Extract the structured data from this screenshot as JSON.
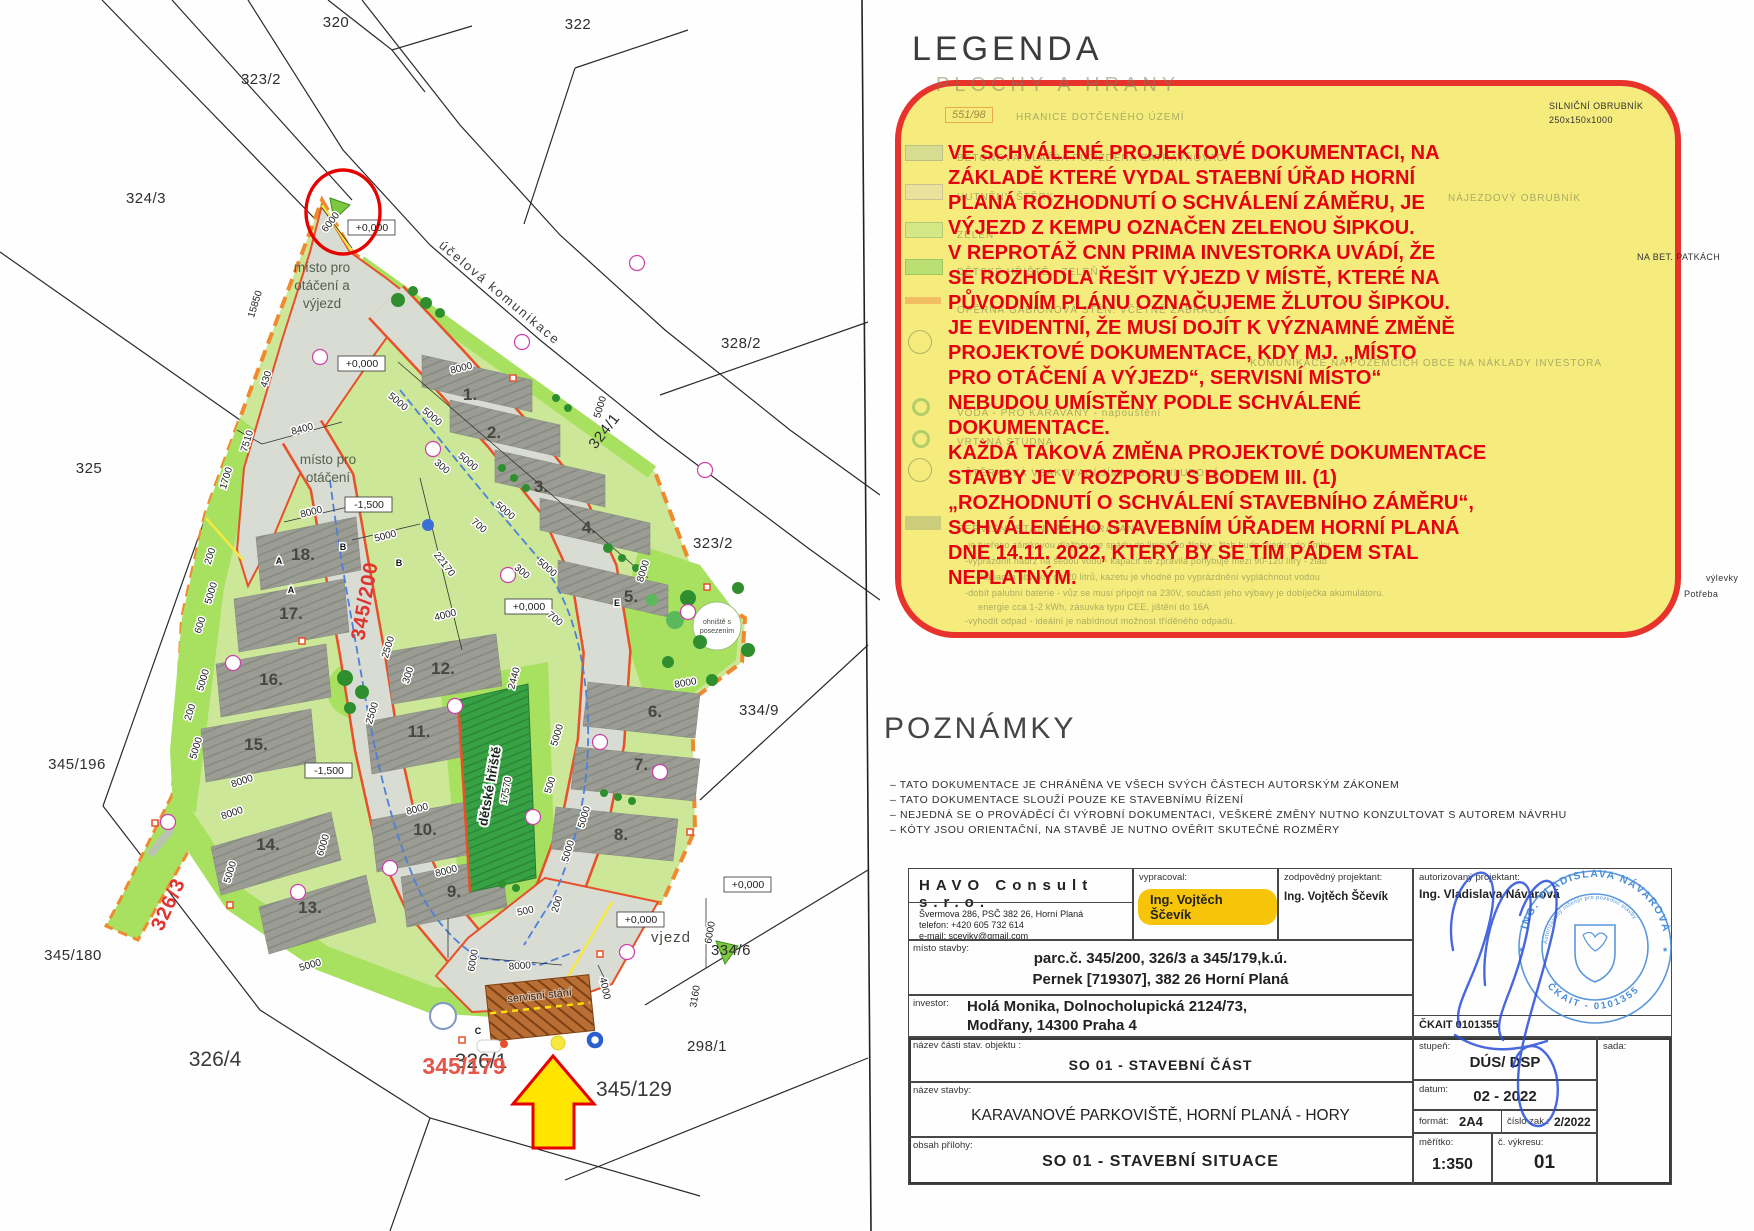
{
  "legend": {
    "title": "LEGENDA",
    "fragments": [
      {
        "t": "PLOCHY A HRANY",
        "x": 936,
        "y": 74,
        "c": "faint-big"
      },
      {
        "t": "551/98",
        "x": 945,
        "y": 107,
        "c": "faint-box"
      },
      {
        "t": "HRANICE DOTČENÉHO ÚZEMÍ",
        "x": 1016,
        "y": 112,
        "c": "faint"
      },
      {
        "t": "BETONOVÁ DLAŽBA POJÍŽDĚNÁ ZATRAVŇOVACÍ",
        "x": 957,
        "y": 153,
        "c": "faint"
      },
      {
        "t": "HUTNĚNÝ ŠTĚRK",
        "x": 957,
        "y": 192,
        "c": "faint"
      },
      {
        "t": "ZELEŇ",
        "x": 957,
        "y": 230,
        "c": "faint"
      },
      {
        "t": "DĚTSKÉ HŘIŠTĚ - ZELEŇ",
        "x": 957,
        "y": 267,
        "c": "faint"
      },
      {
        "t": "OPĚRNÁ GABIONOVÁ STĚN. VČETNĚ ZÁBRADLÍ",
        "x": 957,
        "y": 305,
        "c": "faint"
      },
      {
        "t": "NÁJEZDOVÝ OBRUBNÍK",
        "x": 1448,
        "y": 193,
        "c": "faint"
      },
      {
        "t": "KOMUNIKACE NA POZEMCÍCH OBCE NA NÁKLADY INVESTORA",
        "x": 1250,
        "y": 358,
        "c": "faint"
      },
      {
        "t": "VODA - PRO KARAVANY - napouštění",
        "x": 957,
        "y": 408,
        "c": "faint"
      },
      {
        "t": "VRTANÁ STUDNA",
        "x": 957,
        "y": 437,
        "c": "faint"
      },
      {
        "t": "ŠTĚRKOVÁ VSAKOVACÍ JÍMKA 3x3, HLUBOKÁ 1,5m",
        "x": 965,
        "y": 468,
        "c": "faint"
      },
      {
        "t": "SERVISNÍ STÁNÍ PRO KARAVANY",
        "x": 957,
        "y": 524,
        "c": "faint"
      },
      {
        "t": "-je tvořeno zámkovou dlažbou ve spádu do liniového žlabu - žlab bude sveden do jímky",
        "x": 965,
        "y": 540,
        "c": "faint-small"
      },
      {
        "t": "-vyprázdnit nádrž na šedou vodu - kapacit se zpravila pohybuje mezi 90-120 litry - žlab",
        "x": 965,
        "y": 556,
        "c": "faint-small"
      },
      {
        "t": "- kapacita obvykle do 20 litrů, kazetu je vhodné po vyprázdnění vypláchnout vodou",
        "x": 975,
        "y": 572,
        "c": "faint-small"
      },
      {
        "t": "-dobít palubní baterie - vůz se musí připojit na 230V, součástí jeho výbavy je dobíječka akumulátoru.",
        "x": 965,
        "y": 588,
        "c": "faint-small"
      },
      {
        "t": "energie cca 1-2 kWh, zásuvka typu CEE, jištění do 16A",
        "x": 978,
        "y": 602,
        "c": "faint-small"
      },
      {
        "t": "-vyhodit odpad - ideální je nabídnout možnost tříděného odpadu.",
        "x": 965,
        "y": 616,
        "c": "faint-small"
      }
    ],
    "outside_fragments": [
      {
        "t": "SILNIČNÍ OBRUBNÍK",
        "x": 1549,
        "y": 101,
        "c": "frag"
      },
      {
        "t": "250x150x1000",
        "x": 1549,
        "y": 115,
        "c": "frag"
      },
      {
        "t": "NA BET. PATKÁCH",
        "x": 1637,
        "y": 252,
        "c": "frag"
      },
      {
        "t": "výlevky",
        "x": 1706,
        "y": 573,
        "c": "frag"
      },
      {
        "t": "Potřeba",
        "x": 1684,
        "y": 589,
        "c": "frag"
      }
    ]
  },
  "annotation": {
    "lines": [
      "VE SCHVÁLENÉ PROJEKTOVÉ DOKUMENTACI, NA",
      "ZÁKLADĚ KTERÉ VYDAL STAEBNÍ ÚŘAD HORNÍ",
      "PLANÁ ROZHODNUTÍ O SCHVÁLENÍ ZÁMĚRU, JE",
      "VÝJEZD Z KEMPU OZNAČEN ZELENOU ŠIPKOU.",
      "V REPROTÁŽ CNN PRIMA INVESTORKA UVÁDÍ, ŽE",
      "SE ROZHODLA ŘEŠIT VÝJEZD V MÍSTĚ, KTERÉ NA",
      "PŮVODNÍM PLÁNU OZNAČUJEME ŽLUTOU ŠIPKOU.",
      "JE EVIDENTNÍ, ŽE MUSÍ DOJÍT K VÝZNAMNÉ ZMĚNĚ",
      "PROJEKTOVÉ DOKUMENTACE, KDY MJ. „MÍSTO",
      "PRO OTÁČENÍ A VÝJEZD“, SERVISNÍ MÍSTO“",
      "NEBUDOU UMÍSTĚNY PODLE SCHVÁLENÉ",
      "DOKUMENTACE.",
      "KAŽDÁ TAKOVÁ ZMĚNA PROJEKTOVÉ DOKUMENTACE",
      "STAVBY JE V ROZPORU S BODEM III. (1)",
      "„ROZHODNUTÍ O SCHVÁLENÍ STAVEBNÍHO ZÁMĚRU“,",
      "SCHVÁLENÉHO STAVEBNÍM ÚŘADEM HORNÍ PLANÁ",
      "DNE 14.11. 2022, KTERÝ BY SE TÍM PÁDEM STAL",
      "NEPLATNÝM."
    ]
  },
  "notes": {
    "title": "POZNÁMKY",
    "lines": [
      "– TATO DOKUMENTACE JE CHRÁNĚNA VE VŠECH SVÝCH ČÁSTECH AUTORSKÝM ZÁKONEM",
      "– TATO DOKUMENTACE SLOUŽÍ POUZE KE STAVEBNÍMU ŘÍZENÍ",
      "– NEJEDNÁ SE O PROVÁDĚCÍ ČI VÝROBNÍ DOKUMENTACI, VEŠKERÉ ZMĚNY NUTNO KONZULTOVAT S AUTOREM NÁVRHU",
      "– KÓTY JSOU ORIENTAČNÍ, NA STAVBĚ JE NUTNO OVĚŘIT SKUTEČNÉ ROZMĚRY"
    ]
  },
  "titleblock": {
    "company": "HAVO Consult s.r.o.",
    "address": "Švermova 286, PSČ 382 26, Horní Planá\ntelefon: +420 605 732 614\ne-mail: scevikv@gmail.com",
    "vypracoval_label": "vypracoval:",
    "vypracoval": "Ing. Vojtěch Ščevík",
    "zodpovedny_label": "zodpovědný projektant:",
    "zodpovedny": "Ing. Vojtěch Ščevík",
    "autorizovany_label": "autorizovaný projektant:",
    "autorizovany": "Ing. Vladislava Návarová",
    "ckait": "ČKAIT 0101355",
    "misto_label": "místo stavby:",
    "misto_line1": "parc.č. 345/200, 326/3 a 345/179,k.ú.",
    "misto_line2": "Pernek [719307], 382 26 Horní Planá",
    "investor_label": "investor:",
    "investor_line1": "Holá Monika, Dolnocholupická 2124/73,",
    "investor_line2": "Modřany, 14300 Praha 4",
    "cast_label": "název části stav. objektu :",
    "cast": "SO 01 - STAVEBNÍ ČÁST",
    "stavba_label": "název stavby:",
    "stavba": "KARAVANOVÉ PARKOVIŠTĚ, HORNÍ PLANÁ - HORY",
    "priloha_label": "obsah přílohy:",
    "priloha": "SO 01 - STAVEBNÍ SITUACE",
    "stupen_label": "stupeň:",
    "stupen": "DÚS/ DSP",
    "datum_label": "datum:",
    "datum": "02 - 2022",
    "format_label": "formát:",
    "format": "2A4",
    "cislo_zak_label": "číslo zak.:",
    "cislo_zak": "2/2022",
    "meritko_label": "měřítko:",
    "meritko": "1:350",
    "vykres_label": "č. výkresu:",
    "vykres": "01",
    "sada_label": "sada:"
  },
  "stamp": {
    "name": "ING. VLADISLAVA NÁVAROVÁ",
    "subtitle": "Autorizovaný inženýr pro pozemní stavby",
    "number": "ČKAIT - 0101355"
  },
  "plan": {
    "parcels": [
      {
        "t": "320",
        "x": 336,
        "y": 27,
        "c": "parcel"
      },
      {
        "t": "322",
        "x": 578,
        "y": 29,
        "c": "parcel"
      },
      {
        "t": "323/2",
        "x": 261,
        "y": 84,
        "c": "parcel"
      },
      {
        "t": "324/3",
        "x": 146,
        "y": 203,
        "c": "parcel"
      },
      {
        "t": "325",
        "x": 89,
        "y": 473,
        "c": "parcel"
      },
      {
        "t": "328/2",
        "x": 741,
        "y": 348,
        "c": "parcel"
      },
      {
        "t": "324/1",
        "x": 608,
        "y": 434,
        "r": -52,
        "c": "parcel"
      },
      {
        "t": "323/2",
        "x": 713,
        "y": 548,
        "c": "parcel"
      },
      {
        "t": "334/9",
        "x": 759,
        "y": 715,
        "c": "parcel"
      },
      {
        "t": "345/196",
        "x": 77,
        "y": 769,
        "c": "parcel"
      },
      {
        "t": "345/180",
        "x": 73,
        "y": 960,
        "c": "parcel"
      },
      {
        "t": "326/4",
        "x": 215,
        "y": 1066,
        "c": "parcel-big"
      },
      {
        "t": "334/6",
        "x": 731,
        "y": 955,
        "c": "parcel"
      },
      {
        "t": "345/129",
        "x": 634,
        "y": 1096,
        "c": "parcel-big"
      },
      {
        "t": "298/1",
        "x": 707,
        "y": 1051,
        "c": "parcel"
      },
      {
        "t": "326/1",
        "x": 481,
        "y": 1068,
        "c": "parcel-big"
      }
    ],
    "plot_numbers": [
      {
        "t": "1.",
        "x": 470,
        "y": 400,
        "c": "plotnum"
      },
      {
        "t": "2.",
        "x": 494,
        "y": 438,
        "c": "plotnum"
      },
      {
        "t": "3.",
        "x": 541,
        "y": 492,
        "c": "plotnum"
      },
      {
        "t": "4.",
        "x": 589,
        "y": 533,
        "c": "plotnum"
      },
      {
        "t": "5.",
        "x": 631,
        "y": 602,
        "c": "plotnum"
      },
      {
        "t": "6.",
        "x": 655,
        "y": 717,
        "c": "plotnum"
      },
      {
        "t": "7.",
        "x": 641,
        "y": 770,
        "c": "plotnum"
      },
      {
        "t": "8.",
        "x": 621,
        "y": 840,
        "c": "plotnum"
      },
      {
        "t": "9.",
        "x": 454,
        "y": 897,
        "c": "plotnum"
      },
      {
        "t": "10.",
        "x": 425,
        "y": 835,
        "c": "plotnum"
      },
      {
        "t": "11.",
        "x": 419,
        "y": 737,
        "c": "plotnum"
      },
      {
        "t": "12.",
        "x": 443,
        "y": 674,
        "c": "plotnum"
      },
      {
        "t": "13.",
        "x": 310,
        "y": 913,
        "c": "plotnum"
      },
      {
        "t": "14.",
        "x": 268,
        "y": 850,
        "c": "plotnum"
      },
      {
        "t": "15.",
        "x": 256,
        "y": 750,
        "c": "plotnum"
      },
      {
        "t": "16.",
        "x": 271,
        "y": 685,
        "c": "plotnum"
      },
      {
        "t": "17.",
        "x": 291,
        "y": 619,
        "c": "plotnum"
      },
      {
        "t": "18.",
        "x": 303,
        "y": 560,
        "c": "plotnum"
      }
    ],
    "labels": [
      {
        "t": "účelová komunikace",
        "x": 497,
        "y": 296,
        "r": 40,
        "c": "road-label"
      },
      {
        "t": "místo pro",
        "x": 322,
        "y": 272,
        "c": "area-label"
      },
      {
        "t": "otáčení a",
        "x": 322,
        "y": 290,
        "c": "area-label"
      },
      {
        "t": "výjezd",
        "x": 322,
        "y": 308,
        "c": "area-label"
      },
      {
        "t": "místo pro",
        "x": 328,
        "y": 464,
        "c": "area-label"
      },
      {
        "t": "otáčení",
        "x": 328,
        "y": 482,
        "c": "area-label"
      },
      {
        "t": "dětské hřiště",
        "x": 494,
        "y": 787,
        "r": -80,
        "c": "playground-label"
      },
      {
        "t": "ohniště s",
        "x": 717,
        "y": 624,
        "c": "tiny-label"
      },
      {
        "t": "posezením",
        "x": 717,
        "y": 633,
        "c": "tiny-label"
      },
      {
        "t": "servisní stání",
        "x": 540,
        "y": 999,
        "r": -6,
        "c": "service-label"
      },
      {
        "t": "vjezd",
        "x": 671,
        "y": 942,
        "c": "vjezd-label"
      },
      {
        "t": "345/200",
        "x": 371,
        "y": 602,
        "r": -80,
        "c": "red-label"
      },
      {
        "t": "326/3",
        "x": 174,
        "y": 907,
        "r": -65,
        "c": "red-label"
      },
      {
        "t": "345/179",
        "x": 464,
        "y": 1074,
        "c": "orange-label"
      },
      {
        "t": "A",
        "x": 279,
        "y": 564,
        "c": "section-label"
      },
      {
        "t": "B",
        "x": 343,
        "y": 550,
        "c": "section-label"
      },
      {
        "t": "B",
        "x": 399,
        "y": 566,
        "c": "section-label"
      },
      {
        "t": "A",
        "x": 291,
        "y": 593,
        "c": "section-label"
      },
      {
        "t": "C",
        "x": 478,
        "y": 1034,
        "c": "section-label"
      },
      {
        "t": "E",
        "x": 617,
        "y": 606,
        "c": "section-label"
      }
    ],
    "elevations": [
      {
        "t": "+0,000",
        "x": 372,
        "y": 231,
        "c": "elev"
      },
      {
        "t": "+0,000",
        "x": 362,
        "y": 367,
        "c": "elev"
      },
      {
        "t": "-1,500",
        "x": 369,
        "y": 508,
        "c": "elev"
      },
      {
        "t": "+0,000",
        "x": 529,
        "y": 610,
        "c": "elev"
      },
      {
        "t": "-1,500",
        "x": 329,
        "y": 774,
        "c": "elev"
      },
      {
        "t": "+0,000",
        "x": 641,
        "y": 923,
        "c": "elev"
      },
      {
        "t": "+0,000",
        "x": 748,
        "y": 888,
        "c": "elev"
      }
    ],
    "dimensions": [
      {
        "t": "6000",
        "x": 333,
        "y": 224,
        "r": -52
      },
      {
        "t": "15850",
        "x": 258,
        "y": 305,
        "r": -73
      },
      {
        "t": "430",
        "x": 269,
        "y": 380,
        "r": -73
      },
      {
        "t": "8400",
        "x": 303,
        "y": 432,
        "r": -15
      },
      {
        "t": "7510",
        "x": 250,
        "y": 442,
        "r": -73
      },
      {
        "t": "1700",
        "x": 229,
        "y": 479,
        "r": -73
      },
      {
        "t": "8000",
        "x": 312,
        "y": 515,
        "r": -14
      },
      {
        "t": "5000",
        "x": 386,
        "y": 539,
        "r": -14
      },
      {
        "t": "8000",
        "x": 462,
        "y": 371,
        "r": -14
      },
      {
        "t": "5000",
        "x": 396,
        "y": 404,
        "r": 40
      },
      {
        "t": "5000",
        "x": 430,
        "y": 419,
        "r": 40
      },
      {
        "t": "300",
        "x": 440,
        "y": 469,
        "r": 40
      },
      {
        "t": "5000",
        "x": 466,
        "y": 464,
        "r": 40
      },
      {
        "t": "700",
        "x": 477,
        "y": 528,
        "r": 40
      },
      {
        "t": "5000",
        "x": 503,
        "y": 513,
        "r": 40
      },
      {
        "t": "300",
        "x": 520,
        "y": 574,
        "r": 40
      },
      {
        "t": "5000",
        "x": 545,
        "y": 570,
        "r": 40
      },
      {
        "t": "700",
        "x": 553,
        "y": 621,
        "r": 40
      },
      {
        "t": "5000",
        "x": 603,
        "y": 408,
        "r": -73
      },
      {
        "t": "22170",
        "x": 442,
        "y": 566,
        "r": 52
      },
      {
        "t": "4000",
        "x": 446,
        "y": 618,
        "r": -14
      },
      {
        "t": "2500",
        "x": 391,
        "y": 648,
        "r": -73
      },
      {
        "t": "300",
        "x": 411,
        "y": 676,
        "r": -73
      },
      {
        "t": "2500",
        "x": 375,
        "y": 714,
        "r": -73
      },
      {
        "t": "8000",
        "x": 646,
        "y": 572,
        "r": -73
      },
      {
        "t": "8000",
        "x": 686,
        "y": 686,
        "r": -10
      },
      {
        "t": "8000",
        "x": 418,
        "y": 812,
        "r": -15
      },
      {
        "t": "8000",
        "x": 447,
        "y": 874,
        "r": -15
      },
      {
        "t": "6000",
        "x": 326,
        "y": 846,
        "r": -73
      },
      {
        "t": "8000",
        "x": 243,
        "y": 784,
        "r": -18
      },
      {
        "t": "8000",
        "x": 233,
        "y": 816,
        "r": -18
      },
      {
        "t": "5000",
        "x": 233,
        "y": 873,
        "r": -73
      },
      {
        "t": "5000",
        "x": 311,
        "y": 968,
        "r": -16
      },
      {
        "t": "8000",
        "x": 520,
        "y": 969,
        "r": -4
      },
      {
        "t": "4000",
        "x": 602,
        "y": 989,
        "r": 78
      },
      {
        "t": "6000",
        "x": 476,
        "y": 961,
        "r": -80
      },
      {
        "t": "500",
        "x": 526,
        "y": 914,
        "r": -12
      },
      {
        "t": "3160",
        "x": 698,
        "y": 997,
        "r": -80
      },
      {
        "t": "6000",
        "x": 713,
        "y": 933,
        "r": -80
      },
      {
        "t": "5000",
        "x": 560,
        "y": 736,
        "r": -73
      },
      {
        "t": "500",
        "x": 553,
        "y": 786,
        "r": -73
      },
      {
        "t": "5000",
        "x": 587,
        "y": 818,
        "r": -73
      },
      {
        "t": "17570",
        "x": 509,
        "y": 791,
        "r": -80
      },
      {
        "t": "2440",
        "x": 517,
        "y": 679,
        "r": -75
      },
      {
        "t": "200",
        "x": 213,
        "y": 557,
        "r": -73
      },
      {
        "t": "5000",
        "x": 214,
        "y": 594,
        "r": -73
      },
      {
        "t": "600",
        "x": 203,
        "y": 626,
        "r": -73
      },
      {
        "t": "5000",
        "x": 206,
        "y": 681,
        "r": -73
      },
      {
        "t": "200",
        "x": 193,
        "y": 713,
        "r": -73
      },
      {
        "t": "5000",
        "x": 199,
        "y": 749,
        "r": -73
      },
      {
        "t": "200",
        "x": 560,
        "y": 905,
        "r": -73
      },
      {
        "t": "5000",
        "x": 571,
        "y": 852,
        "r": -73
      }
    ]
  }
}
